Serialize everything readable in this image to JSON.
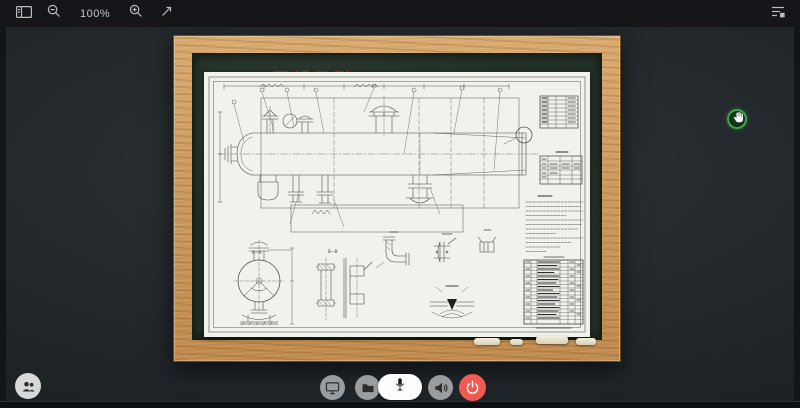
{
  "toolbar": {
    "zoom_level": "100%",
    "icons": [
      "panel-icon",
      "zoom-out-icon",
      "zoom-in-icon",
      "fit-screen-icon",
      "menu-icon"
    ]
  },
  "board": {
    "title": "1.8 图纸示例",
    "drawing": {
      "view_label_aa": "A—A",
      "view_label_bb": "B—B"
    }
  },
  "controls": {
    "icons": [
      "participants-icon",
      "screen-share-icon",
      "folder-icon",
      "microphone-icon",
      "speaker-icon",
      "power-icon"
    ]
  },
  "overlay": {
    "icons": [
      "hand-cursor-icon"
    ]
  },
  "colors": {
    "title_red": "#c42424",
    "power_red": "#ef5a52",
    "hand_badge_green": "#3da543",
    "wood_frame": "#cd9a5e",
    "board_green": "#243229",
    "paper": "#f2f2ec"
  }
}
